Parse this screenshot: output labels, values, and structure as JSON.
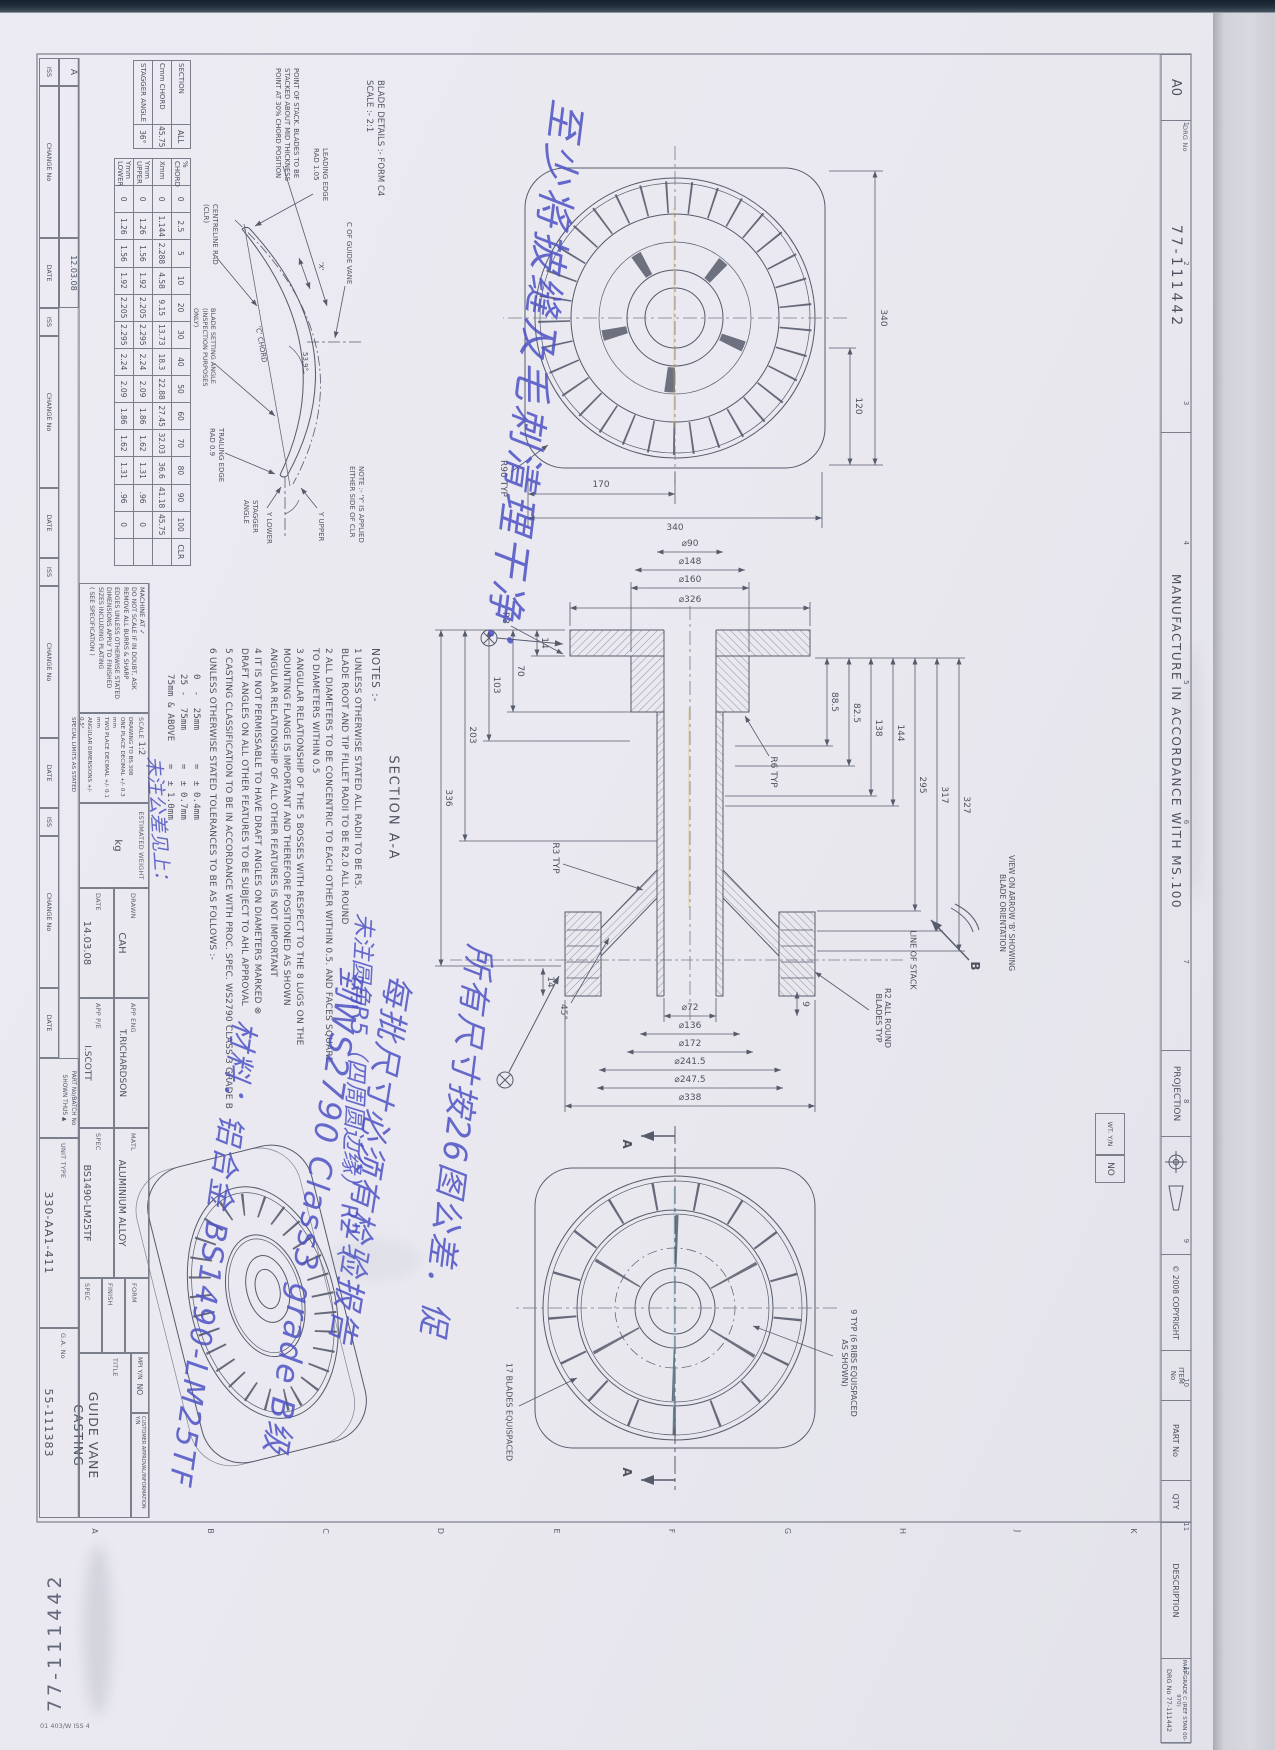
{
  "border": {
    "size": "A0",
    "drg_label": "DRG No",
    "drg_no": "77-111442",
    "manufacture": "MANUFACTURE IN ACCORDANCE WITH MS.100",
    "projection": "PROJECTION",
    "copyright": "© 2008 COPYRIGHT",
    "item_label": "ITEM\nNo",
    "part_label": "PART No",
    "qty_label": "QTY",
    "description_label": "DESCRIPTION",
    "part_grade": "PART GRADE C (REF STAN 00-970)",
    "corner_drg": "DRG No  77-111442",
    "corner_drg_no": "77-111442",
    "zone_numbers": [
      "1",
      "2",
      "3",
      "4",
      "5",
      "6",
      "7",
      "8",
      "9",
      "10",
      "11",
      "12"
    ],
    "zone_letters": [
      "K",
      "J",
      "H",
      "G",
      "F",
      "E",
      "D",
      "C",
      "B",
      "A"
    ],
    "form_code": "01 403/W ISS 4",
    "wt_label": "WT. Y/N",
    "wt_value": "NO"
  },
  "revision": {
    "iss": "ISS",
    "change": "CHANGE No",
    "date": "DATE",
    "entry_iss": "A",
    "entry_change": "",
    "entry_date": "12.03.08"
  },
  "title_block": {
    "machine_at": "MACHINE AT ✓",
    "do_not_scale": "DO NOT SCALE IF IN DOUBT, ASK\nREMOVE ALL BURRS & SHARP\nEDGES UNLESS OTHERWISE STATED\nDIMENSIONS APPLY TO FINISHED\nSIZES INCLUDING PLATING\n( SEE SPECIFICATION )",
    "scale_label": "SCALE",
    "scale": "1:2",
    "standards": "DRAWING TO BS.308\nONE PLACE DECIMAL +/- 0.3 mm\nTWO PLACE DECIMAL +/- 0.1 mm\nANGULAR DIMENSIONS +/- 0.5°\nSPECIAL LIMITS AS STATED",
    "est_weight_label": "ESTIMATED WEIGHT",
    "est_weight": "kg",
    "drawn_label": "DRAWN",
    "drawn": "CAH",
    "date_label": "DATE",
    "date": "14.03.08",
    "app_eng_label": "APP ENG",
    "app_eng": "T.RICHARDSON",
    "app_pe_label": "APP P/E",
    "app_pe": "I.SCOTT",
    "matl_label": "MATL",
    "matl": "ALUMINIUM ALLOY",
    "spec_label": "SPEC",
    "spec": "BS1490-LM25TF",
    "form_label": "FORM",
    "finish_label": "FINISH",
    "spec2_label": "SPEC",
    "mpi_label": "MPI Y/N",
    "mpi": "NO",
    "customer_label": "CUSTOMER APPROVAL/INFORMATION Y/N",
    "title_label": "TITLE",
    "title": "GUIDE VANE CASTING",
    "unit_label": "UNIT TYPE",
    "unit": "330-AA1-411",
    "part_batch_label": "PART No/BATCH No",
    "part_batch_note": "SHOWN THUS ▲",
    "ga_label": "G.A. No",
    "ga": "55-111383"
  },
  "blade_table": {
    "caption": "BLADE DETAILS :- FORM C4\nSCALE :- 2:1",
    "stack_note": "POINT OF STACK. BLADES TO BE\nSTACKED ABOUT MID THICKNESS\nPOINT AT 30% CHORD POSITION",
    "y_note": "NOTE :- 'Y' IS APPLIED\nEITHER SIDE OF CLR",
    "cl_label": "C OF GUIDE VANE",
    "le_label": "LEADING EDGE\nRAD 1.05",
    "x_label": "'X'",
    "angle_539": "53.9°",
    "chord_label": "'C' CHORD",
    "clr_label": "CENTRELINE RAD\n(CLR)",
    "te_label": "TRAILING EDGE\nRAD 0.9",
    "setting_label": "BLADE SETTING ANGLE\n(INSPECTION PURPOSES\nONLY)",
    "stagger_label": "STAGGER\nANGLE",
    "y_upper": "Y UPPER",
    "y_lower": "Y LOWER",
    "info": [
      [
        "SECTION",
        "ALL"
      ],
      [
        "Cmm CHORD",
        "45.75"
      ],
      [
        "STAGGER ANGLE",
        "36°"
      ]
    ],
    "grid": [
      [
        "% CHORD",
        "0",
        "2.5",
        "5",
        "10",
        "20",
        "30",
        "40",
        "50",
        "60",
        "70",
        "80",
        "90",
        "100",
        "CLR"
      ],
      [
        "Xmm",
        "0",
        "1.144",
        "2.288",
        "4.58",
        "9.15",
        "13.73",
        "18.3",
        "22.88",
        "27.45",
        "32.03",
        "36.6",
        "41.18",
        "45.75",
        ""
      ],
      [
        "Ymm UPPER",
        "0",
        "1.26",
        "1.56",
        "1.92",
        "2.205",
        "2.295",
        "2.24",
        "2.09",
        "1.86",
        "1.62",
        "1.31",
        ".96",
        "0",
        ""
      ],
      [
        "Ymm LOWER",
        "0",
        "1.26",
        "1.56",
        "1.92",
        "2.205",
        "2.295",
        "2.24",
        "2.09",
        "1.86",
        "1.62",
        "1.31",
        ".96",
        "0",
        ""
      ]
    ]
  },
  "notes": {
    "heading": "NOTES :-",
    "n1": "1   UNLESS OTHERWISE STATED ALL RADII TO BE R5.\n     BLADE ROOT AND TIP FILLET RADII TO BE R2.0 ALL ROUND",
    "n2": "2   ALL DIAMETERS TO BE CONCENTRIC TO EACH OTHER WITHIN 0.5. AND FACES SQUARE\n     TO DIAMETERS WITHIN 0.5",
    "n3": "3   ANGULAR RELATIONSHIP OF THE 5 BOSSES WITH RESPECT TO THE 8 LUGS ON THE\n     MOUNTING FLANGE IS IMPORTANT AND THEREFORE POSITIONED AS SHOWN\n     ANGULAR RELATIONSHIP OF ALL OTHER FEATURES IS NOT IMPORTANT",
    "n4": "4   IT IS NOT PERMISSABLE TO HAVE DRAFT ANGLES ON DIAMETERS MARKED ⊗\n     DRAFT ANGLES ON ALL OTHER FEATURES TO BE SUBJECT TO AHL APPROVAL",
    "n5": "5   CASTING CLASSIFICATION TO BE IN ACCORDANCE WITH PROC. SPEC. WS2790 CLASS 3 GRADE B",
    "n6": "6   UNLESS OTHERWISE STATED TOLERANCES TO BE AS FOLLOWS :-",
    "tolerances": "0  -  25mm      =  ± 0.4mm\n25 -  75mm      =  ± 0.7mm\n75mm & ABOVE    =  ± 1.0mm"
  },
  "views": {
    "top_view": {
      "w": "340",
      "w_part": "120",
      "h": "340",
      "h_part": "170",
      "corner": "R90 TYP"
    },
    "section": {
      "caption": "SECTION  A-A",
      "d326": "⌀326",
      "d160": "⌀160",
      "d148": "⌀148",
      "d90": "⌀90",
      "d72": "⌀72",
      "d136": "⌀136",
      "d172": "⌀172",
      "d2415": "⌀241.5",
      "d2475": "⌀247.5",
      "d338": "⌀338",
      "a885": "88.5",
      "a825": "82.5",
      "a138": "138",
      "a144": "144",
      "a295": "295",
      "a317": "317",
      "a327": "327",
      "b14": "14",
      "b70": "70",
      "b103": "103",
      "b203": "203",
      "b336": "336",
      "tip14": "14",
      "nine": "9",
      "angle45": "45°",
      "r6": "R6 TYP",
      "r3": "R3",
      "r3t": "R3 TYP",
      "r2": "R2 ALL ROUND\nBLADES TYP",
      "stack": "LINE OF STACK",
      "view_b": "VIEW ON ARROW 'B' SHOWING\nBLADE ORIENTATION",
      "b": "B"
    },
    "bottom_view": {
      "blades": "17 BLADES EQUISPACED",
      "ribs": "9 TYP (6 RIBS EQUISPACED\nAS SHOWN)",
      "a1": "A",
      "a2": "A"
    }
  },
  "annotations": {
    "a1": "至少将披缝及毛刺清理干净：",
    "a2": "未注圆角R5（四周圆边缘） R2（",
    "a3": "所有尺寸按26图公差．促",
    "a4": "每批尺寸必须有检验报告\n到WS2790 Class3 grade B级",
    "a5": "材料：铝合金 BS1490-LM25TF",
    "a6": "未注公差见上："
  }
}
